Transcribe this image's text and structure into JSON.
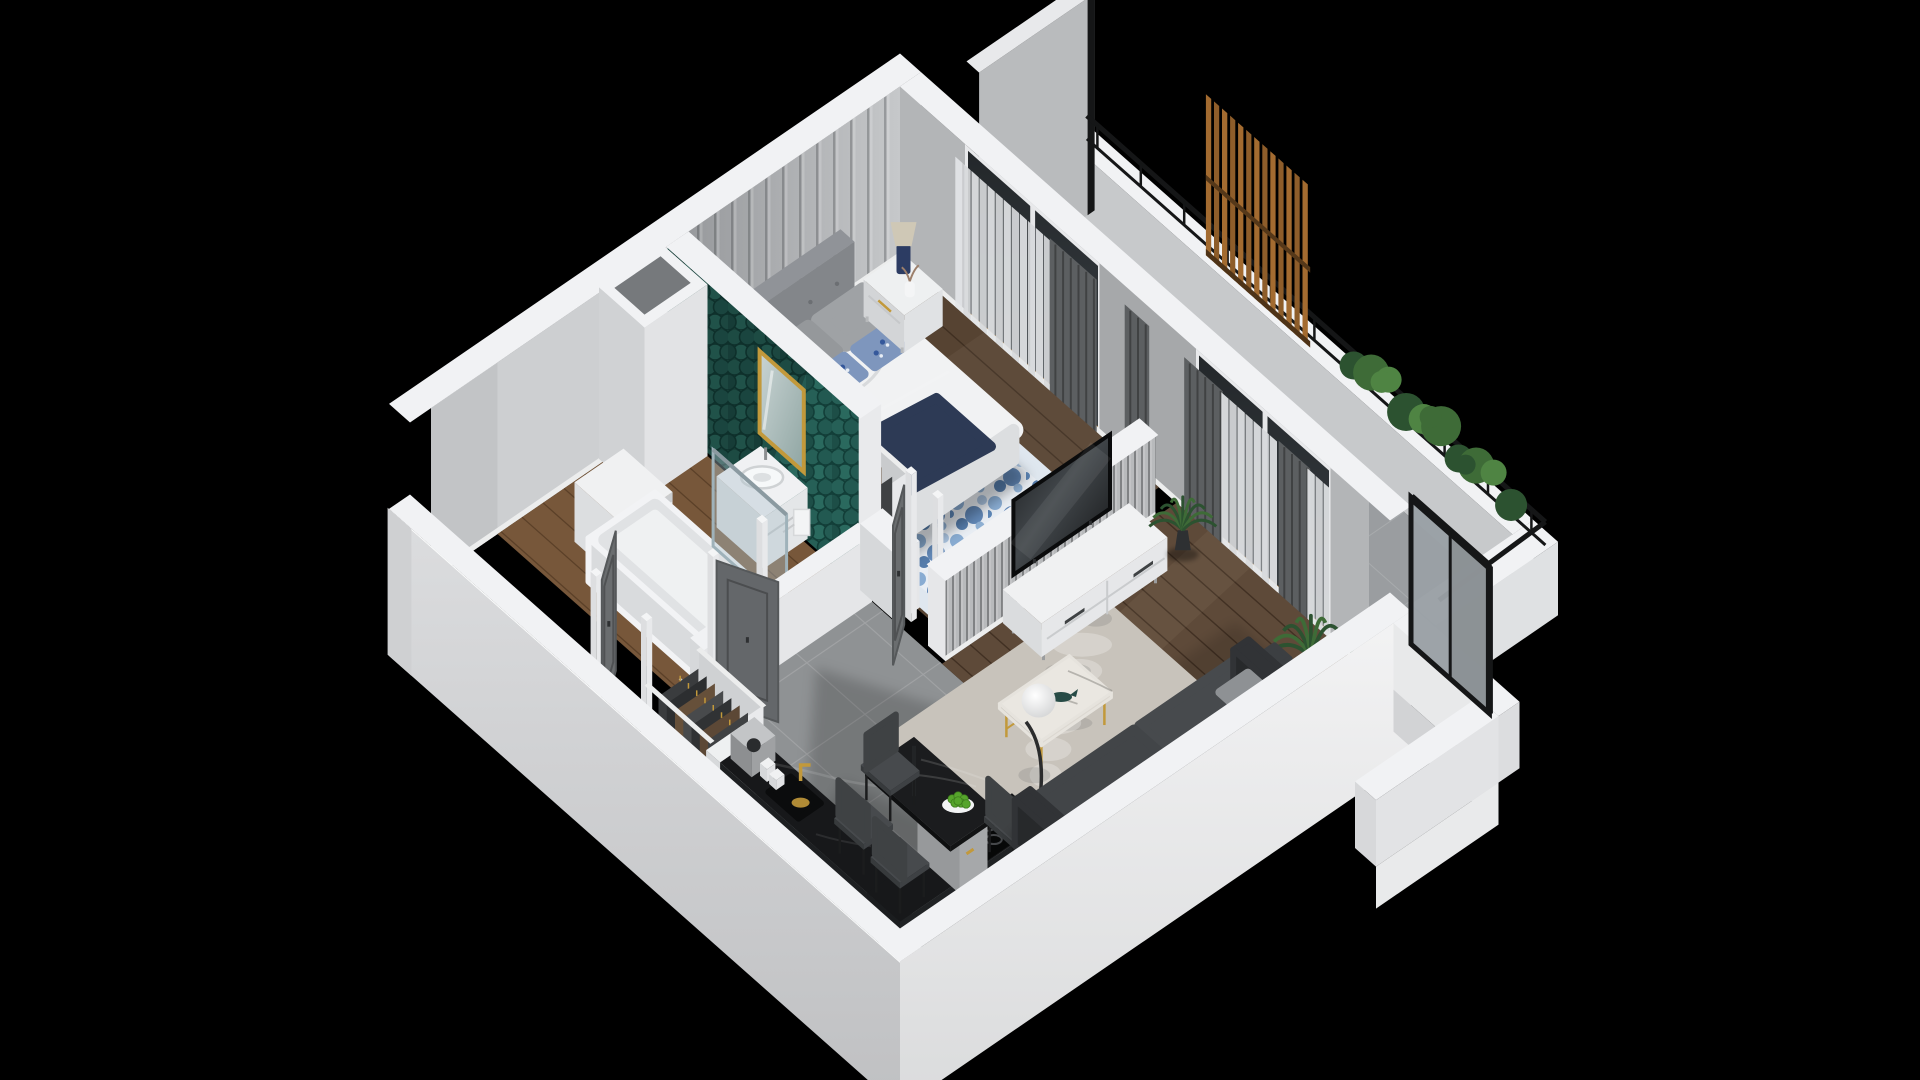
{
  "scene": {
    "type": "isometric-3d-apartment-floor-plan-cutaway",
    "background": "#000000",
    "rooms": [
      {
        "id": "balcony",
        "name": "Balcony",
        "floor": "gray-tile",
        "items": [
          "white-parapet",
          "black-metal-railing",
          "wood-slat-privacy-screen",
          "planter-hedge",
          "gray-privacy-panel"
        ]
      },
      {
        "id": "bedroom",
        "name": "Bedroom",
        "floor": "dark-wood-planks",
        "items": [
          "upholstered-bed",
          "white-duvet",
          "navy-throw-blanket",
          "gray-pillows",
          "blue-floral-accent-pillows",
          "nightstand-left",
          "nightstand-right",
          "table-lamp",
          "blue-floral-area-rug",
          "open-wardrobe-with-clothes",
          "paneled-accent-wall",
          "sheer-and-graphite-curtains",
          "floor-to-ceiling-window"
        ]
      },
      {
        "id": "bathroom",
        "name": "Bathroom",
        "floor": "wood-planks",
        "items": [
          "teal-fishscale-tile-wall",
          "gold-framed-mirror",
          "vanity-sink-with-towel",
          "bathtub-with-glass-screen",
          "washing-machine",
          "service-shaft"
        ]
      },
      {
        "id": "hallway",
        "name": "Entry Hall",
        "floor": "gray-tile",
        "items": [
          "entry-door-open",
          "bathroom-door-open",
          "bedroom-door-open",
          "open-closet-with-clothes"
        ]
      },
      {
        "id": "kitchen",
        "name": "Kitchen",
        "floor": "gray-tile",
        "items": [
          "black-marble-counter",
          "gold-faucet-sink",
          "induction-hob",
          "coffee-machine",
          "black-marble-dining-table",
          "bowl-of-green-apples",
          "dining-chairs"
        ]
      },
      {
        "id": "living",
        "name": "Living Room",
        "floor": "dark-wood-planks",
        "items": [
          "ribbed-tv-half-wall",
          "wall-tv",
          "white-tv-lowboard",
          "marble-coffee-table-gold-legs",
          "whale-figurine",
          "globe-floor-lamp",
          "charcoal-sofa",
          "gray-shag-rug",
          "potted-palms",
          "floor-to-ceiling-windows"
        ]
      },
      {
        "id": "terrace",
        "name": "Side Terrace",
        "floor": "none-visible",
        "items": [
          "white-parapet",
          "glass-privacy-screen-black-frame"
        ]
      }
    ],
    "palette": {
      "bg": "#000000",
      "wallTop": "#f1f2f4",
      "wallFaceLight": "#dfe1e3",
      "wallFaceMid": "#c7c9cb",
      "wallFaceDark": "#aeb0b3",
      "panelBase": "#b6b8ba",
      "apronSWTop": "#dcdddf",
      "apronSWBot": "#c2c3c5",
      "apronSETop": "#f2f2f3",
      "apronSEBot": "#dcdddf",
      "teal": "#2c665d",
      "tealDark": "#17463f",
      "gold": "#c2993b",
      "woodBedroom": "#6a523e",
      "woodLiving": "#5e4a39",
      "woodBath": "#77573a",
      "tileGray": "#8f9294",
      "tileLine": "#a0a2a4",
      "rugWhite": "#e9eef4",
      "rugBlue": "#4a77ad",
      "rugLiving": "#c8c3bb",
      "sofa": "#3a3d3f",
      "sofaSeat": "#474a4d",
      "counterBlack": "#17181a",
      "marbleWhite": "#eae7e1",
      "curtainDark": "#5c5f61",
      "curtainSheer": "#dcdee0",
      "tvBlack": "#101214",
      "plantGreen": "#3e6b37",
      "plantDark": "#2c5230",
      "woodSlat": "#8e5d2a",
      "railBlack": "#151617",
      "glassScreen": "#9aa0a5",
      "doorGray": "#6a6d6f",
      "doorGrayDark": "#55585a",
      "lampNavy": "#2c3c63",
      "lampShade": "#cfc8b6",
      "throwNavy": "#2d3a55",
      "duvetWhite": "#f1f2f3",
      "headboardGray": "#83868a",
      "pillowGray": "#9fa2a5",
      "pillowBlue": "#7e96bd",
      "appleGreen": "#56a42c",
      "white": "#ececee",
      "bedFrame": "#4a4038",
      "chairDark": "#3f4244",
      "plate": "#f2f3f4"
    }
  }
}
